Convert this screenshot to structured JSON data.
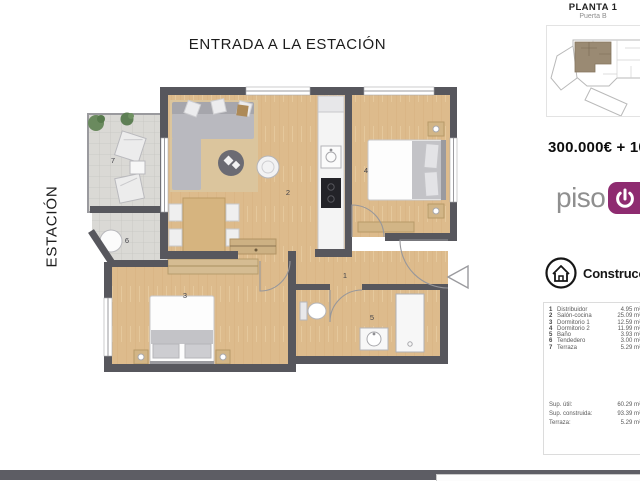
{
  "labels": {
    "top": "ENTRADA A LA ESTACIÓN",
    "left": "ESTACIÓN"
  },
  "keyplan": {
    "title": "PLANTA 1",
    "subtitle": "Puerta B",
    "unit_highlight_color": "#9a8a73"
  },
  "pricing": {
    "price": "300.000€ + 10%"
  },
  "brand": {
    "prefix": "piso",
    "badge_letter": "n",
    "accent": "#8e2b70"
  },
  "builder": {
    "name": "Construcciones"
  },
  "legend": {
    "rooms": [
      {
        "num": "1",
        "name": "Distribuidor",
        "area": "4.95 m²"
      },
      {
        "num": "2",
        "name": "Salón-cocina",
        "area": "25.09 m²"
      },
      {
        "num": "3",
        "name": "Dormitorio 1",
        "area": "12.59 m²"
      },
      {
        "num": "4",
        "name": "Dormitorio 2",
        "area": "11.99 m²"
      },
      {
        "num": "5",
        "name": "Baño",
        "area": "3.93 m²"
      },
      {
        "num": "6",
        "name": "Tendedero",
        "area": "3.00 m²"
      },
      {
        "num": "7",
        "name": "Terraza",
        "area": "5.29 m²"
      }
    ],
    "totals": [
      {
        "label": "Sup. útil:",
        "value": "60.29 m²"
      },
      {
        "label": "Sup. construida:",
        "value": "93.39 m²"
      },
      {
        "label": "Terraza:",
        "value": "5.29 m²"
      }
    ]
  }
}
